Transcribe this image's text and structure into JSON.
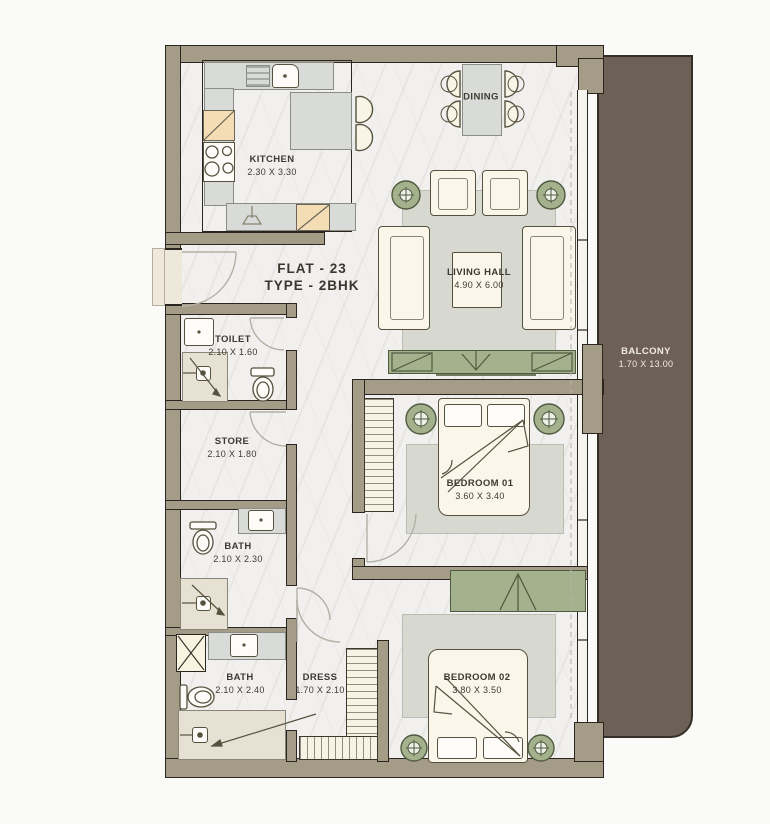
{
  "plan": {
    "title": "FLAT - 23",
    "subtitle": "TYPE - 2BHK",
    "rooms": {
      "kitchen": {
        "name": "KITCHEN",
        "dims": "2.30 X 3.30"
      },
      "dining": {
        "name": "DINING",
        "dims": ""
      },
      "living": {
        "name": "LIVING HALL",
        "dims": "4.90 X 6.00"
      },
      "toilet": {
        "name": "TOILET",
        "dims": "2.10 X 1.60"
      },
      "store": {
        "name": "STORE",
        "dims": "2.10 X 1.80"
      },
      "bath1": {
        "name": "BATH",
        "dims": "2.10 X 2.30"
      },
      "bath2": {
        "name": "BATH",
        "dims": "2.10 X 2.40"
      },
      "dress": {
        "name": "DRESS",
        "dims": "1.70 X 2.10"
      },
      "bedroom1": {
        "name": "BEDROOM 01",
        "dims": "3.60 X 3.40"
      },
      "bedroom2": {
        "name": "BEDROOM 02",
        "dims": "3.80 X 3.50"
      },
      "balcony": {
        "name": "BALCONY",
        "dims": "1.70 X 13.00"
      }
    },
    "colors": {
      "wall": "#a59c88",
      "balcony": "#6d6056",
      "sage_green": "#a3b28d",
      "furniture_cream": "#faf6ea",
      "counter_gray": "#d9dbd8",
      "rug_gray": "#d7d9d1",
      "floor": "#f1f0ee",
      "cabinet_tan": "#f4ddb4",
      "outline": "#2a261f",
      "balcony_text": "#efece4",
      "label_text": "#3e3a33"
    }
  }
}
